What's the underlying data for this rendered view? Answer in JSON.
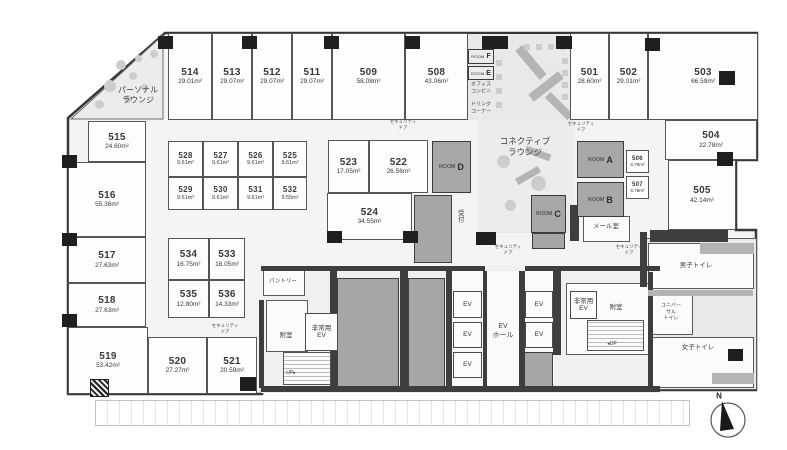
{
  "colors": {
    "wall": "#3e3e3e",
    "pillar": "#1f1f1f",
    "shaft": "#a6a6a6",
    "room_fill": "#fdfdfd",
    "common_fill": "#e9e9e9",
    "text": "#3d3d3d"
  },
  "compass": {
    "label": "N"
  },
  "rooms": [
    {
      "id": "514",
      "area": "29.01m²",
      "x": 168,
      "y": 33,
      "w": 44,
      "h": 87
    },
    {
      "id": "513",
      "area": "29.07m²",
      "x": 212,
      "y": 33,
      "w": 40,
      "h": 87
    },
    {
      "id": "512",
      "area": "29.07m²",
      "x": 252,
      "y": 33,
      "w": 40,
      "h": 87
    },
    {
      "id": "511",
      "area": "29.07m²",
      "x": 292,
      "y": 33,
      "w": 40,
      "h": 87
    },
    {
      "id": "509",
      "area": "58.08m²",
      "x": 332,
      "y": 33,
      "w": 73,
      "h": 87
    },
    {
      "id": "508",
      "area": "43.06m²",
      "x": 405,
      "y": 33,
      "w": 63,
      "h": 87
    },
    {
      "id": "501",
      "area": "28.60m²",
      "x": 570,
      "y": 33,
      "w": 39,
      "h": 87
    },
    {
      "id": "502",
      "area": "29.01m²",
      "x": 609,
      "y": 33,
      "w": 39,
      "h": 87
    },
    {
      "id": "503",
      "area": "66.59m²",
      "x": 648,
      "y": 33,
      "w": 110,
      "h": 87
    },
    {
      "id": "515",
      "area": "24.60m²",
      "x": 88,
      "y": 121,
      "w": 58,
      "h": 41
    },
    {
      "id": "516",
      "area": "55.36m²",
      "x": 68,
      "y": 162,
      "w": 78,
      "h": 75
    },
    {
      "id": "517",
      "area": "27.63m²",
      "x": 68,
      "y": 237,
      "w": 78,
      "h": 46
    },
    {
      "id": "518",
      "area": "27.63m²",
      "x": 68,
      "y": 283,
      "w": 78,
      "h": 44
    },
    {
      "id": "519",
      "area": "53.42m²",
      "x": 68,
      "y": 327,
      "w": 80,
      "h": 67
    },
    {
      "id": "520",
      "area": "27.27m²",
      "x": 148,
      "y": 337,
      "w": 59,
      "h": 57
    },
    {
      "id": "521",
      "area": "20.59m²",
      "x": 207,
      "y": 337,
      "w": 50,
      "h": 57
    },
    {
      "id": "528",
      "area": "9.61m²",
      "x": 168,
      "y": 141,
      "w": 35,
      "h": 36,
      "cls": "small"
    },
    {
      "id": "527",
      "area": "9.61m²",
      "x": 203,
      "y": 141,
      "w": 35,
      "h": 36,
      "cls": "small"
    },
    {
      "id": "526",
      "area": "9.61m²",
      "x": 238,
      "y": 141,
      "w": 35,
      "h": 36,
      "cls": "small"
    },
    {
      "id": "525",
      "area": "9.61m²",
      "x": 273,
      "y": 141,
      "w": 34,
      "h": 36,
      "cls": "small"
    },
    {
      "id": "529",
      "area": "9.61m²",
      "x": 168,
      "y": 177,
      "w": 35,
      "h": 33,
      "cls": "small"
    },
    {
      "id": "530",
      "area": "9.61m²",
      "x": 203,
      "y": 177,
      "w": 35,
      "h": 33,
      "cls": "small"
    },
    {
      "id": "531",
      "area": "9.61m²",
      "x": 238,
      "y": 177,
      "w": 35,
      "h": 33,
      "cls": "small"
    },
    {
      "id": "532",
      "area": "9.55m²",
      "x": 273,
      "y": 177,
      "w": 34,
      "h": 33,
      "cls": "small"
    },
    {
      "id": "523",
      "area": "17.05m²",
      "x": 328,
      "y": 140,
      "w": 41,
      "h": 53
    },
    {
      "id": "522",
      "area": "26.56m²",
      "x": 369,
      "y": 140,
      "w": 59,
      "h": 53
    },
    {
      "id": "524",
      "area": "34.55m²",
      "x": 327,
      "y": 193,
      "w": 85,
      "h": 47
    },
    {
      "id": "534",
      "area": "16.75m²",
      "x": 168,
      "y": 238,
      "w": 41,
      "h": 42
    },
    {
      "id": "533",
      "area": "18.05m²",
      "x": 209,
      "y": 238,
      "w": 36,
      "h": 42
    },
    {
      "id": "535",
      "area": "12.80m²",
      "x": 168,
      "y": 280,
      "w": 41,
      "h": 38
    },
    {
      "id": "536",
      "area": "14.33m²",
      "x": 209,
      "y": 280,
      "w": 36,
      "h": 38
    },
    {
      "id": "504",
      "area": "22.78m²",
      "x": 665,
      "y": 120,
      "w": 92,
      "h": 40
    },
    {
      "id": "505",
      "area": "42.14m²",
      "x": 668,
      "y": 160,
      "w": 68,
      "h": 70
    },
    {
      "id": "506",
      "area": "6.78m²",
      "x": 626,
      "y": 150,
      "w": 23,
      "h": 23,
      "cls": "mini"
    },
    {
      "id": "507",
      "area": "6.78m²",
      "x": 626,
      "y": 176,
      "w": 23,
      "h": 23,
      "cls": "mini"
    }
  ],
  "meeting_rooms": [
    {
      "word": "ROOM",
      "letter": "A",
      "x": 577,
      "y": 141,
      "w": 47,
      "h": 37
    },
    {
      "word": "ROOM",
      "letter": "B",
      "x": 577,
      "y": 182,
      "w": 47,
      "h": 35
    },
    {
      "word": "ROOM",
      "letter": "C",
      "x": 531,
      "y": 195,
      "w": 35,
      "h": 38
    },
    {
      "word": "ROOM",
      "letter": "D",
      "x": 432,
      "y": 141,
      "w": 39,
      "h": 52
    },
    {
      "word": "ROOM",
      "letter": "F",
      "x": 468,
      "y": 49,
      "w": 26,
      "h": 15,
      "cls": "mini"
    },
    {
      "word": "ROOM",
      "letter": "E",
      "x": 468,
      "y": 66,
      "w": 26,
      "h": 14,
      "cls": "mini"
    }
  ],
  "elevators": {
    "label": "EV",
    "cells": [
      {
        "x": 453,
        "y": 291,
        "w": 29,
        "h": 27
      },
      {
        "x": 453,
        "y": 322,
        "w": 29,
        "h": 26
      },
      {
        "x": 453,
        "y": 352,
        "w": 29,
        "h": 26
      },
      {
        "x": 525,
        "y": 291,
        "w": 28,
        "h": 27
      },
      {
        "x": 525,
        "y": 322,
        "w": 28,
        "h": 26
      }
    ]
  },
  "emergency_elevators": {
    "label": "非常用\nEV",
    "cells": [
      {
        "x": 305,
        "y": 313,
        "w": 33,
        "h": 38
      },
      {
        "x": 570,
        "y": 291,
        "w": 27,
        "h": 28
      }
    ]
  },
  "labels": [
    {
      "name": "personal-lounge-label",
      "text": "パーソナル\nラウンジ",
      "x": 138,
      "y": 96,
      "s": 8
    },
    {
      "name": "connective-lounge-label",
      "text": "コネクティブ\nラウンジ",
      "x": 525,
      "y": 147,
      "s": 8.5
    },
    {
      "name": "office-conbini-label",
      "text": "オフィス\nコンビニ",
      "x": 481,
      "y": 88,
      "s": 5
    },
    {
      "name": "drink-corner-label",
      "text": "ドリンク\nコーナー",
      "x": 481,
      "y": 108,
      "s": 5
    },
    {
      "name": "reception-label",
      "text": "受付",
      "x": 459,
      "y": 216,
      "s": 6.5,
      "vert": true
    },
    {
      "name": "mail-room-label",
      "text": "メール室",
      "x": 606,
      "y": 227,
      "s": 6.5
    },
    {
      "name": "pantry-label",
      "text": "パントリー",
      "x": 283,
      "y": 282,
      "s": 5.5
    },
    {
      "name": "vestibule-left-label",
      "text": "附室",
      "x": 286,
      "y": 336,
      "s": 6.5
    },
    {
      "name": "ev-hall-label",
      "text": "EV\nホール",
      "x": 503,
      "y": 331,
      "s": 7
    },
    {
      "name": "vestibule-right-label",
      "text": "附室",
      "x": 616,
      "y": 308,
      "s": 6.5
    },
    {
      "name": "mens-toilet-label",
      "text": "男子トイレ",
      "x": 696,
      "y": 266,
      "s": 6.5
    },
    {
      "name": "universal-toilet-label",
      "text": "ユニバー\nサル\nトイレ",
      "x": 671,
      "y": 312,
      "s": 5
    },
    {
      "name": "womens-toilet-label",
      "text": "女子トイレ",
      "x": 698,
      "y": 348,
      "s": 6.5
    },
    {
      "name": "stairs-up-left-label",
      "text": "UP▸",
      "x": 291,
      "y": 373,
      "s": 5
    },
    {
      "name": "stairs-up-right-label",
      "text": "◂UP",
      "x": 612,
      "y": 344,
      "s": 5
    }
  ],
  "security_door": {
    "text": "セキュリティ\nドア",
    "positions": [
      {
        "x": 403,
        "y": 125
      },
      {
        "x": 581,
        "y": 127
      },
      {
        "x": 508,
        "y": 250
      },
      {
        "x": 629,
        "y": 250
      },
      {
        "x": 225,
        "y": 329
      }
    ]
  },
  "walls": [
    [
      261,
      266,
      224,
      5
    ],
    [
      525,
      266,
      135,
      5
    ],
    [
      330,
      271,
      7,
      117
    ],
    [
      400,
      271,
      8,
      117
    ],
    [
      446,
      271,
      6,
      117
    ],
    [
      483,
      271,
      4,
      115
    ],
    [
      519,
      271,
      6,
      117
    ],
    [
      553,
      271,
      8,
      84
    ],
    [
      261,
      386,
      399,
      6
    ],
    [
      259,
      300,
      5,
      88
    ],
    [
      648,
      272,
      5,
      118
    ],
    [
      640,
      232,
      7,
      55
    ],
    [
      650,
      230,
      78,
      12
    ],
    [
      570,
      205,
      9,
      36
    ]
  ],
  "shafts": [
    [
      337,
      278,
      62,
      110
    ],
    [
      408,
      278,
      37,
      110
    ],
    [
      524,
      352,
      29,
      36
    ],
    [
      414,
      195,
      38,
      68
    ],
    [
      532,
      233,
      33,
      16
    ]
  ],
  "pillars": [
    [
      158,
      36,
      15,
      13
    ],
    [
      242,
      36,
      15,
      13
    ],
    [
      324,
      36,
      15,
      13
    ],
    [
      405,
      36,
      15,
      13
    ],
    [
      482,
      36,
      26,
      13
    ],
    [
      556,
      36,
      16,
      13
    ],
    [
      645,
      38,
      15,
      13
    ],
    [
      719,
      71,
      16,
      14
    ],
    [
      717,
      152,
      16,
      14
    ],
    [
      62,
      155,
      15,
      13
    ],
    [
      62,
      233,
      15,
      13
    ],
    [
      62,
      314,
      15,
      13
    ],
    [
      240,
      377,
      16,
      14
    ],
    [
      327,
      231,
      15,
      12
    ],
    [
      403,
      231,
      15,
      12
    ],
    [
      476,
      232,
      20,
      13
    ],
    [
      728,
      349,
      15,
      12
    ]
  ],
  "hatch_pillars": [
    [
      90,
      379,
      17,
      16
    ]
  ],
  "white_boxes": [
    [
      583,
      216,
      47,
      26
    ],
    [
      263,
      270,
      42,
      26
    ],
    [
      266,
      300,
      42,
      52
    ],
    [
      566,
      283,
      84,
      72
    ],
    [
      648,
      243,
      106,
      46
    ],
    [
      648,
      293,
      45,
      42
    ],
    [
      648,
      337,
      106,
      51
    ]
  ],
  "open_floors": [
    [
      452,
      271,
      102,
      115
    ]
  ],
  "stairs": [
    [
      283,
      352,
      48,
      33
    ],
    [
      587,
      320,
      57,
      31
    ]
  ],
  "furniture_mid": [
    [
      512,
      58,
      38,
      9,
      50
    ],
    [
      527,
      82,
      38,
      9,
      -38
    ],
    [
      543,
      102,
      32,
      8,
      45
    ],
    [
      525,
      150,
      26,
      7,
      20
    ],
    [
      515,
      172,
      26,
      7,
      -30
    ],
    [
      700,
      243,
      54,
      11,
      0
    ],
    [
      648,
      290,
      105,
      6,
      0
    ],
    [
      712,
      373,
      42,
      11,
      0
    ]
  ],
  "furniture_light": [
    [
      524,
      44,
      6,
      6,
      0,
      0
    ],
    [
      536,
      44,
      6,
      6,
      0,
      0
    ],
    [
      548,
      44,
      6,
      6,
      0,
      0
    ],
    [
      560,
      44,
      6,
      6,
      0,
      0
    ],
    [
      562,
      58,
      6,
      6,
      0,
      0
    ],
    [
      562,
      70,
      6,
      6,
      0,
      0
    ],
    [
      562,
      82,
      6,
      6,
      0,
      0
    ],
    [
      562,
      94,
      6,
      6,
      0,
      0
    ],
    [
      496,
      60,
      6,
      6,
      0,
      0
    ],
    [
      496,
      74,
      6,
      6,
      0,
      0
    ],
    [
      496,
      88,
      6,
      6,
      0,
      0
    ],
    [
      496,
      102,
      6,
      6,
      0,
      0
    ],
    [
      497,
      155,
      13,
      13,
      0,
      1
    ],
    [
      531,
      176,
      15,
      15,
      0,
      1
    ],
    [
      505,
      200,
      11,
      11,
      0,
      1
    ],
    [
      544,
      209,
      11,
      11,
      0,
      1
    ],
    [
      116,
      60,
      10,
      10,
      0,
      1
    ],
    [
      129,
      72,
      8,
      8,
      0,
      1
    ],
    [
      104,
      80,
      12,
      12,
      0,
      1
    ],
    [
      95,
      100,
      9,
      9,
      0,
      1
    ],
    [
      124,
      95,
      8,
      8,
      0,
      1
    ],
    [
      141,
      84,
      7,
      7,
      0,
      1
    ],
    [
      150,
      50,
      8,
      8,
      0,
      1
    ],
    [
      135,
      55,
      7,
      7,
      0,
      1
    ],
    [
      584,
      149,
      34,
      9,
      0,
      0
    ],
    [
      584,
      161,
      34,
      9,
      0,
      0
    ],
    [
      584,
      190,
      34,
      9,
      0,
      0
    ],
    [
      584,
      202,
      34,
      9,
      0,
      0
    ],
    [
      537,
      203,
      23,
      22,
      0,
      0
    ],
    [
      438,
      150,
      27,
      34,
      0,
      0
    ]
  ]
}
